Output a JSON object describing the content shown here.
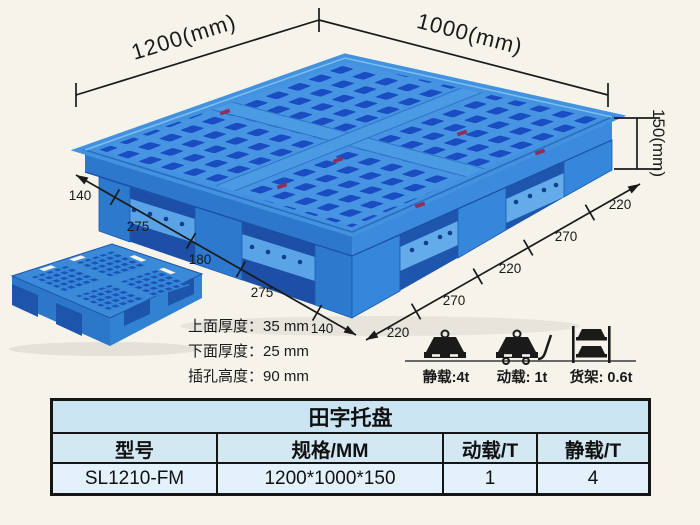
{
  "diagram": {
    "length_label": "1200(mm)",
    "width_label": "1000(mm)",
    "height_label": "150(mm)",
    "bottom_edge_segments_mm": [
      "140",
      "275",
      "180",
      "275",
      "140"
    ],
    "right_edge_segments_mm": [
      "220",
      "270",
      "220",
      "270",
      "220"
    ],
    "spec_lines": [
      "上面厚度：35 mm",
      "下面厚度：25 mm",
      "插孔高度：90 mm"
    ]
  },
  "loads": {
    "items": [
      {
        "icon": "static-load-icon",
        "label": "静载:4t"
      },
      {
        "icon": "dynamic-load-icon",
        "label": "动载: 1t"
      },
      {
        "icon": "rack-load-icon",
        "label": "货架: 0.6t"
      }
    ]
  },
  "table": {
    "title": "田字托盘",
    "headers": [
      "型号",
      "规格/MM",
      "动载/T",
      "静载/T"
    ],
    "rows": [
      [
        "SL1210-FM",
        "1200*1000*150",
        "1",
        "4"
      ]
    ]
  },
  "colors": {
    "pallet_blue": "#2e7ed2",
    "pallet_dark_blue": "#1a4cc2",
    "pallet_light_blue": "#4694e2",
    "dimension_line": "#1a1a1a",
    "table_header_bg": "#cde6f3",
    "table_row_bg": "#e3f2fa",
    "background": "#f6f3ea"
  }
}
